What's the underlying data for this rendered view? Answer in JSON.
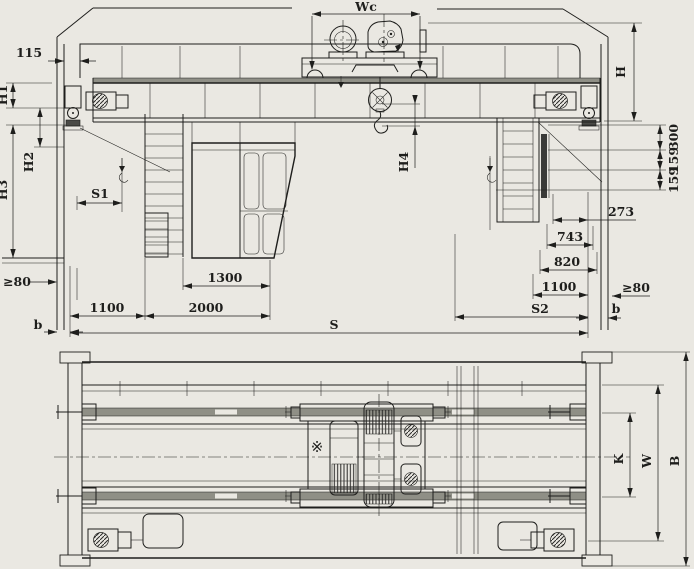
{
  "drawing": {
    "title": "Double girder overhead bridge crane general arrangement drawing",
    "background_color": "#eae8e2",
    "line_color": "#1e1e1c",
    "views": {
      "elevation": {
        "name": "front-elevation",
        "dims": {
          "wc": "Wc",
          "d115": "115",
          "h1": "H1",
          "h2": "H2",
          "h3": "H3",
          "h4": "H4",
          "h": "H",
          "s1": "S1",
          "s2": "S2",
          "s": "S",
          "d300": "300",
          "d159a": "159",
          "d159b": "159",
          "d273": "273",
          "d743": "743",
          "d820": "820",
          "d1100_right": "1100",
          "d1300": "1300",
          "d2000": "2000",
          "d1100_left": "1100",
          "ge80_left": "≥80",
          "ge80_right": "≥80",
          "b_left": "b",
          "b_right": "b"
        }
      },
      "plan": {
        "name": "plan-view",
        "dims": {
          "k": "K",
          "w": "W",
          "b": "B"
        },
        "symbols": {
          "drum_position_mark": "※"
        }
      }
    }
  }
}
